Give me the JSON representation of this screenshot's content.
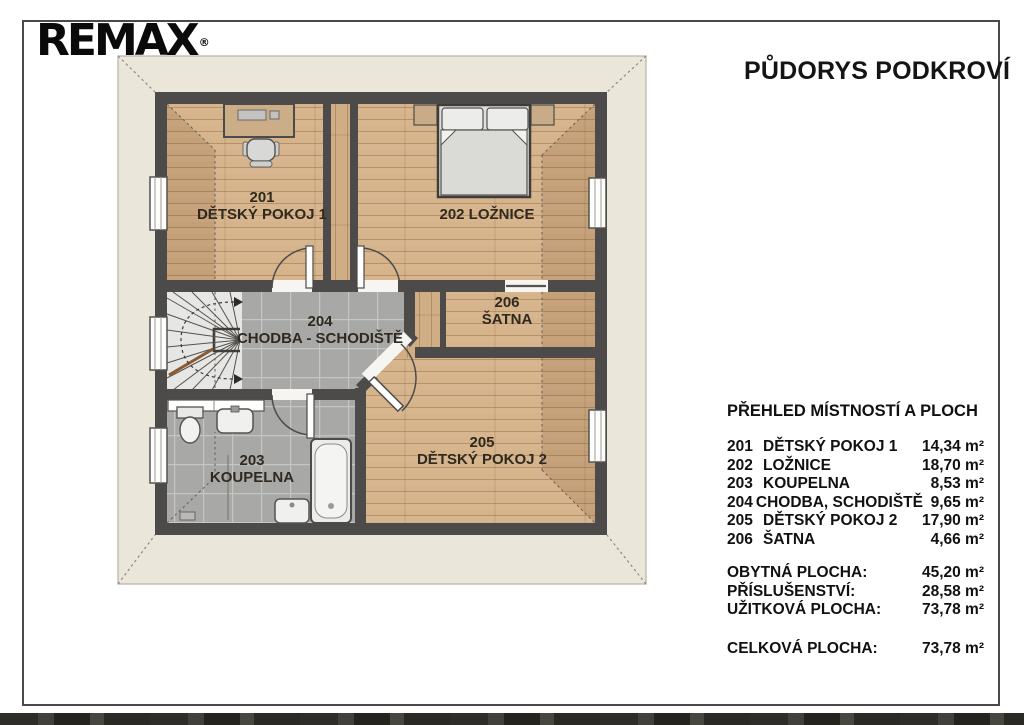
{
  "logo": {
    "text": "REMAX",
    "reg": "®"
  },
  "title": "PŮDORYS PODKROVÍ",
  "plan": {
    "labels": [
      {
        "l1": "201",
        "l2": "DĚTSKÝ POKOJ 1"
      },
      {
        "l1": "202 LOŽNICE",
        "l2": ""
      },
      {
        "l1": "204",
        "l2": "CHODBA - SCHODIŠTĚ"
      },
      {
        "l1": "206",
        "l2": "ŠATNA"
      },
      {
        "l1": "203",
        "l2": "KOUPELNA"
      },
      {
        "l1": "205",
        "l2": "DĚTSKÝ POKOJ 2"
      }
    ]
  },
  "legend": {
    "heading": "PŘEHLED MÍSTNOSTÍ A PLOCH",
    "rows": [
      {
        "num": "201",
        "name": "DĚTSKÝ POKOJ 1",
        "area": "14,34 m²"
      },
      {
        "num": "202",
        "name": "LOŽNICE",
        "area": "18,70 m²"
      },
      {
        "num": "203",
        "name": "KOUPELNA",
        "area": "8,53 m²"
      },
      {
        "num": "204",
        "name": "CHODBA, SCHODIŠTĚ",
        "area": "9,65 m²"
      },
      {
        "num": "205",
        "name": "DĚTSKÝ POKOJ 2",
        "area": "17,90 m²"
      },
      {
        "num": "206",
        "name": "ŠATNA",
        "area": "4,66 m²"
      }
    ],
    "summary": [
      {
        "label": "OBYTNÁ PLOCHA:",
        "value": "45,20 m²"
      },
      {
        "label": "PŘÍSLUŠENSTVÍ:",
        "value": "28,58 m²"
      },
      {
        "label": "UŽITKOVÁ PLOCHA:",
        "value": "73,78 m²"
      }
    ],
    "total": {
      "label": "CELKOVÁ PLOCHA:",
      "value": "73,78 m²"
    }
  },
  "colors": {
    "wall": "#4d4b49",
    "wood_floor": "#d7b68f",
    "tile_floor": "#a8a8a6",
    "roof_area": "#eae6da",
    "logo_text": "#0a0a0a"
  }
}
